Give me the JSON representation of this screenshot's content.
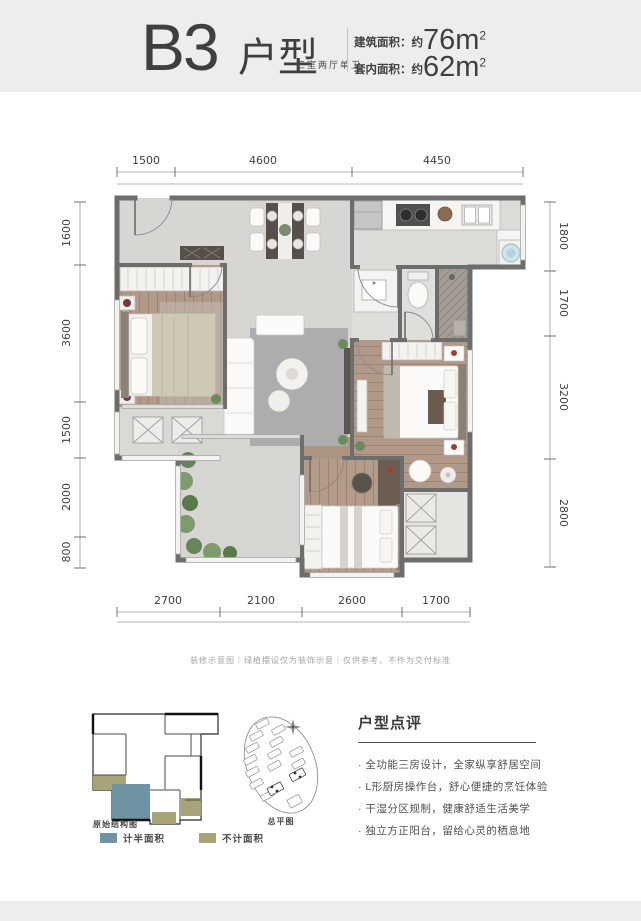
{
  "header": {
    "title_main": "B3",
    "title_suffix": "户型",
    "subtitle": "三室两厅单卫",
    "area1_label": "建筑面积：约",
    "area1_value": "76m",
    "area1_sup": "2",
    "area2_label": "套内面积：约",
    "area2_value": "62m",
    "area2_sup": "2"
  },
  "floor_plan": {
    "dimensions_mm": {
      "top": [
        "1500",
        "4600",
        "4450"
      ],
      "bottom": [
        "2700",
        "2100",
        "2600",
        "1700"
      ],
      "left": [
        "1600",
        "3600",
        "1500",
        "2000",
        "800"
      ],
      "right": [
        "1800",
        "1700",
        "3200",
        "2800"
      ]
    }
  },
  "disclaimer": "装修示意图｜绿植摆设仅为装饰示意｜仅供参考，不作为交付标准",
  "schematic": {
    "label": "原始结构图",
    "legend": [
      {
        "label": "计半面积",
        "color": "#6e93a2"
      },
      {
        "label": "不计面积",
        "color": "#a9a478"
      }
    ]
  },
  "site_plan": {
    "label": "总平图"
  },
  "review": {
    "title": "户型点评",
    "bullets": [
      "· 全功能三房设计，全家纵享舒居空间",
      "· L形厨房操作台，舒心便捷的烹饪体验",
      "· 干湿分区规制，健康舒适生活美学",
      "· 独立方正阳台，留给心灵的栖息地"
    ]
  }
}
